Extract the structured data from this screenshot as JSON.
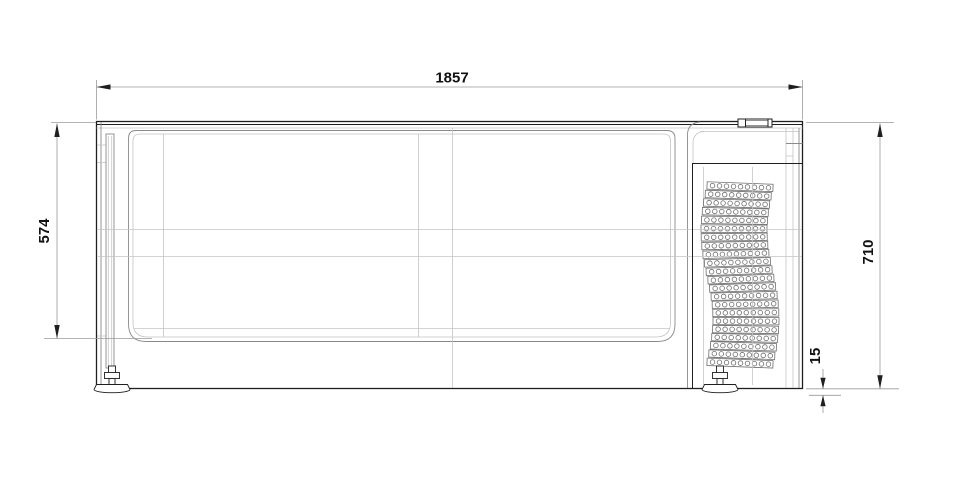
{
  "drawing": {
    "dimensions": {
      "overall_width": {
        "label": "1857",
        "value": 1857
      },
      "front_height": {
        "label": "574",
        "value": 574
      },
      "overall_height": {
        "label": "710",
        "value": 710
      },
      "foot_clearance": {
        "label": "15",
        "value": 15
      }
    },
    "grille": {
      "rows": 22,
      "holes_per_row": 9
    },
    "colors": {
      "background": "#ffffff",
      "line_dark": "#1f1f1f",
      "line_medium": "#8a8a8a",
      "line_light": "#c4c4c4",
      "line_dim": "#9a9a9a",
      "grille_line": "#6e6e6e",
      "text_color": "#111111"
    }
  }
}
